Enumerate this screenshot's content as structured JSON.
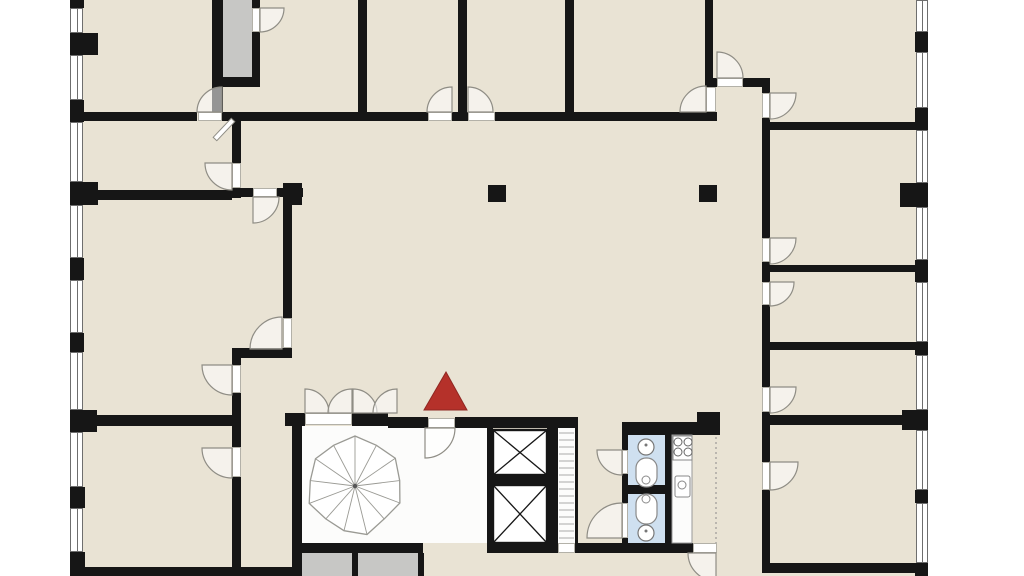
{
  "title": "building-floor-plan",
  "colors": {
    "page_bg": "#ffffff",
    "floor_beige": "#e9e3d4",
    "wall_black": "#161616",
    "shaft_gray": "#c7c7c5",
    "lobby_white": "#fcfcfb",
    "wc_blue": "#cfe0f0",
    "arc_stroke": "#8f8d85",
    "fixture_stroke": "#8a8a8a",
    "marker_red": "#b5312a",
    "marker_red_dark": "#8f2722"
  },
  "marker": {
    "shape": "triangle",
    "color": "#b5312a",
    "stroke": "#8f2722",
    "points": [
      [
        446,
        372
      ],
      [
        424,
        410
      ],
      [
        467,
        410
      ]
    ]
  },
  "plan": {
    "width": 1024,
    "height": 576,
    "building": [
      70,
      0,
      858,
      576
    ],
    "floors": [
      {
        "t": "gray",
        "name": "stair-shaft",
        "r": [
          223,
          0,
          29,
          77
        ]
      },
      {
        "t": "white",
        "name": "stairwell-lobby",
        "r": [
          302,
          426,
          188,
          117
        ]
      },
      {
        "t": "white",
        "name": "service-shaft",
        "r": [
          558,
          428,
          17,
          115
        ]
      },
      {
        "t": "gray",
        "name": "basement-stair-box",
        "r": [
          302,
          553,
          50,
          23
        ]
      },
      {
        "t": "gray",
        "name": "basement-stair-box",
        "r": [
          358,
          553,
          60,
          23
        ]
      },
      {
        "t": "blue",
        "name": "wc-room",
        "r": [
          628,
          435,
          37,
          108
        ]
      },
      {
        "t": "white",
        "name": "kitchen-counter",
        "r": [
          672,
          435,
          20,
          108
        ]
      }
    ],
    "walls": [
      [
        70,
        0,
        14,
        8
      ],
      [
        70,
        33,
        28,
        22
      ],
      [
        70,
        100,
        14,
        22
      ],
      [
        70,
        182,
        28,
        23
      ],
      [
        70,
        258,
        14,
        22
      ],
      [
        70,
        333,
        14,
        19
      ],
      [
        70,
        410,
        27,
        22
      ],
      [
        70,
        487,
        15,
        21
      ],
      [
        70,
        552,
        15,
        24
      ],
      [
        915,
        32,
        13,
        20
      ],
      [
        915,
        108,
        13,
        22
      ],
      [
        900,
        183,
        28,
        24
      ],
      [
        915,
        260,
        13,
        22
      ],
      [
        915,
        342,
        13,
        13
      ],
      [
        902,
        410,
        26,
        20
      ],
      [
        915,
        490,
        13,
        13
      ],
      [
        915,
        563,
        13,
        13
      ],
      [
        212,
        0,
        11,
        121
      ],
      [
        252,
        0,
        8,
        8
      ],
      [
        252,
        32,
        8,
        45
      ],
      [
        212,
        77,
        48,
        10
      ],
      [
        358,
        0,
        9,
        112
      ],
      [
        458,
        0,
        9,
        112
      ],
      [
        565,
        0,
        9,
        112
      ],
      [
        705,
        0,
        8,
        80
      ],
      [
        83,
        112,
        114,
        9
      ],
      [
        222,
        112,
        206,
        9
      ],
      [
        452,
        112,
        16,
        9
      ],
      [
        495,
        112,
        211,
        9
      ],
      [
        706,
        112,
        11,
        9
      ],
      [
        705,
        78,
        12,
        9
      ],
      [
        743,
        78,
        27,
        9
      ],
      [
        762,
        78,
        8,
        15
      ],
      [
        762,
        118,
        8,
        12
      ],
      [
        762,
        122,
        155,
        8
      ],
      [
        762,
        130,
        8,
        108
      ],
      [
        762,
        262,
        8,
        20
      ],
      [
        762,
        305,
        8,
        82
      ],
      [
        762,
        412,
        8,
        50
      ],
      [
        762,
        490,
        8,
        83
      ],
      [
        768,
        265,
        147,
        7
      ],
      [
        768,
        342,
        147,
        8
      ],
      [
        768,
        415,
        134,
        10
      ],
      [
        762,
        563,
        166,
        10
      ],
      [
        232,
        121,
        9,
        42
      ],
      [
        232,
        188,
        9,
        10
      ],
      [
        97,
        190,
        135,
        10
      ],
      [
        241,
        188,
        12,
        9
      ],
      [
        277,
        188,
        26,
        9
      ],
      [
        283,
        183,
        19,
        22
      ],
      [
        283,
        205,
        9,
        113
      ],
      [
        283,
        348,
        9,
        10
      ],
      [
        232,
        348,
        60,
        10
      ],
      [
        232,
        358,
        9,
        7
      ],
      [
        232,
        393,
        9,
        54
      ],
      [
        232,
        477,
        9,
        93
      ],
      [
        83,
        415,
        149,
        11
      ],
      [
        70,
        567,
        222,
        9
      ],
      [
        285,
        413,
        20,
        13
      ],
      [
        352,
        413,
        36,
        13
      ],
      [
        388,
        417,
        40,
        11
      ],
      [
        455,
        417,
        35,
        11
      ],
      [
        292,
        426,
        10,
        150
      ],
      [
        292,
        543,
        131,
        10
      ],
      [
        352,
        553,
        6,
        23
      ],
      [
        418,
        553,
        6,
        23
      ],
      [
        490,
        417,
        88,
        11
      ],
      [
        487,
        428,
        6,
        125
      ],
      [
        488,
        475,
        62,
        10
      ],
      [
        547,
        428,
        11,
        115
      ],
      [
        575,
        428,
        3,
        115
      ],
      [
        490,
        543,
        68,
        10
      ],
      [
        575,
        543,
        118,
        10
      ],
      [
        622,
        422,
        75,
        13
      ],
      [
        697,
        412,
        23,
        23
      ],
      [
        622,
        422,
        6,
        28
      ],
      [
        622,
        474,
        6,
        29
      ],
      [
        622,
        538,
        6,
        15
      ],
      [
        665,
        435,
        7,
        108
      ],
      [
        628,
        485,
        44,
        9
      ],
      [
        488,
        185,
        18,
        17
      ],
      [
        699,
        185,
        18,
        17
      ]
    ],
    "windows": [
      [
        70,
        8,
        13,
        25
      ],
      [
        70,
        55,
        13,
        45
      ],
      [
        70,
        122,
        13,
        60
      ],
      [
        70,
        205,
        13,
        53
      ],
      [
        70,
        280,
        13,
        53
      ],
      [
        70,
        352,
        13,
        58
      ],
      [
        70,
        432,
        13,
        55
      ],
      [
        70,
        508,
        13,
        44
      ],
      [
        916,
        0,
        12,
        32
      ],
      [
        916,
        52,
        12,
        56
      ],
      [
        916,
        130,
        12,
        53
      ],
      [
        916,
        207,
        12,
        53
      ],
      [
        916,
        282,
        12,
        60
      ],
      [
        916,
        355,
        12,
        55
      ],
      [
        916,
        430,
        12,
        60
      ],
      [
        916,
        503,
        12,
        60
      ]
    ],
    "thresholds": [
      [
        198,
        112,
        24,
        9
      ],
      [
        428,
        112,
        24,
        9
      ],
      [
        468,
        112,
        27,
        9
      ],
      [
        252,
        8,
        8,
        24
      ],
      [
        717,
        78,
        26,
        9
      ],
      [
        706,
        87,
        10,
        25
      ],
      [
        762,
        93,
        8,
        25
      ],
      [
        762,
        238,
        8,
        24
      ],
      [
        762,
        282,
        8,
        23
      ],
      [
        762,
        387,
        8,
        25
      ],
      [
        762,
        462,
        8,
        28
      ],
      [
        253,
        188,
        24,
        9
      ],
      [
        283,
        318,
        9,
        30
      ],
      [
        232,
        163,
        9,
        25
      ],
      [
        232,
        365,
        9,
        28
      ],
      [
        232,
        447,
        9,
        30
      ],
      [
        428,
        418,
        27,
        10
      ],
      [
        622,
        450,
        6,
        24
      ],
      [
        622,
        503,
        6,
        35
      ],
      [
        693,
        543,
        24,
        10
      ],
      [
        305,
        413,
        47,
        12
      ],
      [
        558,
        543,
        17,
        10
      ]
    ],
    "arcs": [
      [
        222,
        112,
        25,
        180,
        270
      ],
      [
        452,
        112,
        25,
        180,
        270
      ],
      [
        468,
        112,
        25,
        270,
        360
      ],
      [
        260,
        8,
        24,
        0,
        90
      ],
      [
        717,
        78,
        26,
        270,
        360
      ],
      [
        706,
        112,
        26,
        180,
        270
      ],
      [
        770,
        93,
        26,
        0,
        90
      ],
      [
        770,
        238,
        26,
        0,
        90
      ],
      [
        770,
        282,
        24,
        0,
        90
      ],
      [
        770,
        387,
        26,
        0,
        90
      ],
      [
        770,
        462,
        28,
        0,
        90
      ],
      [
        253,
        197,
        26,
        0,
        90
      ],
      [
        282,
        349,
        32,
        180,
        270
      ],
      [
        232,
        163,
        27,
        90,
        180
      ],
      [
        232,
        365,
        30,
        90,
        180
      ],
      [
        232,
        448,
        30,
        90,
        180
      ],
      [
        425,
        428,
        30,
        0,
        90
      ],
      [
        622,
        450,
        25,
        90,
        180
      ],
      [
        622,
        538,
        35,
        180,
        270
      ],
      [
        716,
        553,
        28,
        90,
        180
      ],
      [
        305,
        413,
        24,
        270,
        360
      ],
      [
        352,
        413,
        24,
        180,
        270
      ],
      [
        353,
        413,
        24,
        270,
        360
      ],
      [
        397,
        413,
        24,
        180,
        270
      ]
    ],
    "door_leaf_diagonal": [
      [
        231.2,
        118.3
      ],
      [
        234.8,
        121.7
      ],
      [
        216.8,
        140.7
      ],
      [
        213.2,
        137.3
      ]
    ],
    "stair": {
      "cx": 355,
      "cy": 486,
      "spokes": 13,
      "radii": [
        50,
        46,
        49,
        45,
        48,
        44,
        50,
        46,
        44,
        49,
        45,
        48,
        46
      ]
    },
    "elevators": [
      [
        493,
        430,
        54,
        45
      ],
      [
        493,
        485,
        54,
        58
      ]
    ],
    "ladder": {
      "x1": 559,
      "x2": 574,
      "y0": 433,
      "y1": 540,
      "step": 7
    },
    "bathroom": {
      "sinks": [
        [
          646,
          447,
          8
        ],
        [
          646,
          533,
          8
        ]
      ],
      "toilets": [
        [
          636,
          458,
          21,
          29
        ],
        [
          636,
          494,
          21,
          30
        ]
      ],
      "toilet_seats": [
        [
          646,
          480,
          4
        ],
        [
          646,
          499,
          4
        ]
      ]
    },
    "kitchen": {
      "counter_outline": [
        672,
        435,
        20,
        108
      ],
      "stove": [
        673,
        436,
        19,
        24
      ],
      "burners": [
        [
          678,
          442
        ],
        [
          688,
          442
        ],
        [
          678,
          452
        ],
        [
          688,
          452
        ]
      ],
      "sink_rect": [
        675,
        476,
        15,
        21
      ],
      "sink_circle": [
        682,
        485,
        4
      ]
    },
    "dashed_lines": [
      [
        716,
        437,
        716,
        543
      ]
    ]
  }
}
